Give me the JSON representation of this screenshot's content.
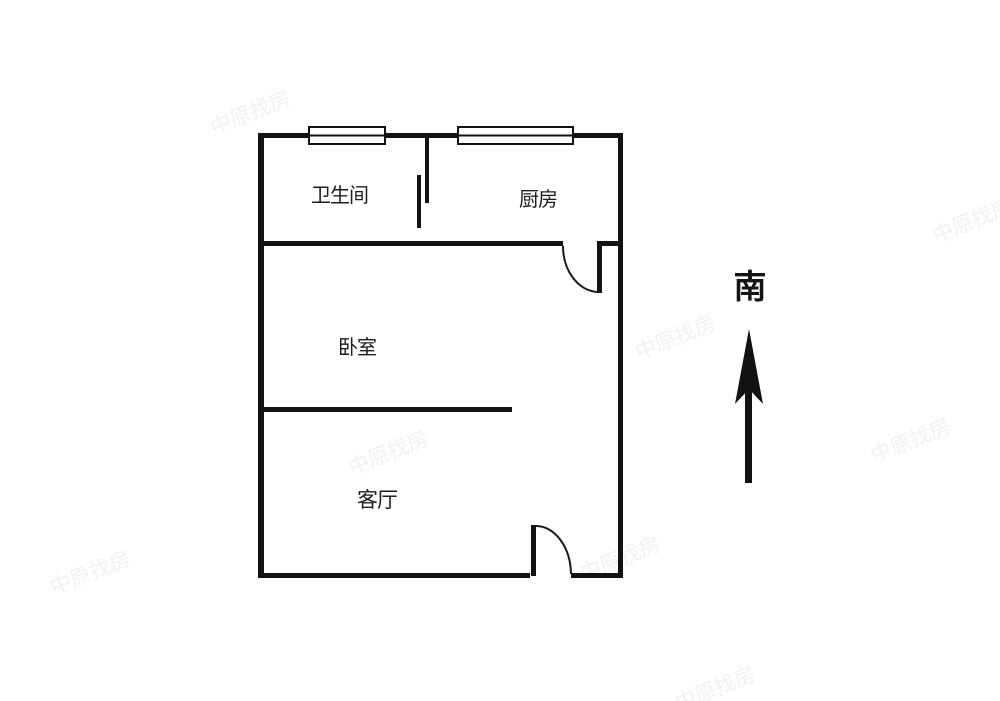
{
  "floorplan": {
    "rooms": [
      {
        "id": "bathroom",
        "label": "卫生间"
      },
      {
        "id": "kitchen",
        "label": "厨房"
      },
      {
        "id": "bedroom",
        "label": "卧室"
      },
      {
        "id": "living-room",
        "label": "客厅"
      }
    ],
    "compass": {
      "label": "南",
      "arrow_direction": "up"
    },
    "watermark": {
      "text": "中原找房"
    },
    "colors": {
      "wall": "#121212",
      "background": "#ffffff",
      "label_text": "#1e1e1e",
      "compass_text": "#141414"
    }
  }
}
